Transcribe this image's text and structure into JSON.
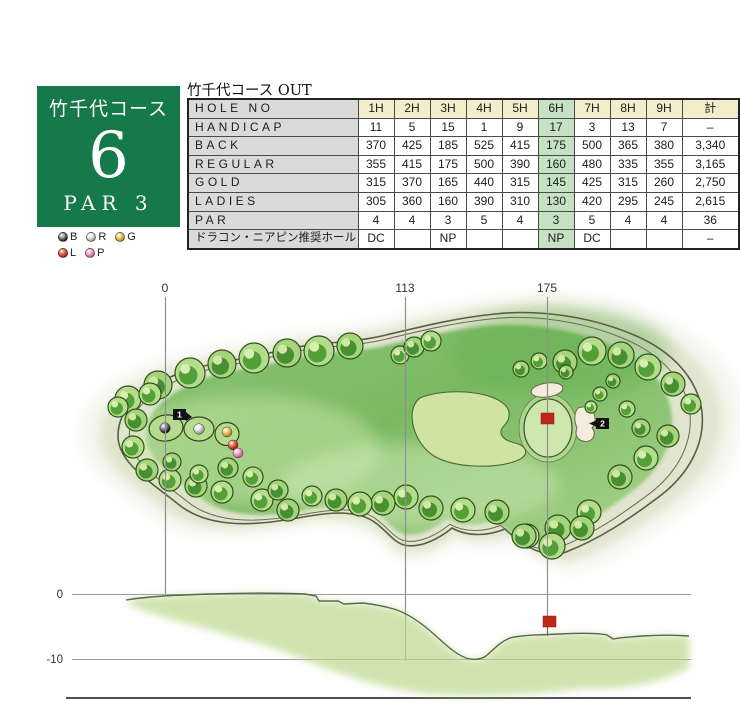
{
  "hole_card": {
    "course_name": "竹千代コース",
    "hole_number": "6",
    "par_label": "PAR 3",
    "bg_color": "#15794a"
  },
  "tee_legend": [
    {
      "label": "B",
      "light": "#9aa0a6",
      "dark": "#101418"
    },
    {
      "label": "R",
      "light": "#f0f0f0",
      "dark": "#8c9094"
    },
    {
      "label": "G",
      "light": "#f5d97e",
      "dark": "#b07c22"
    },
    {
      "label": "L",
      "light": "#e97b64",
      "dark": "#9c1a0c"
    },
    {
      "label": "P",
      "light": "#f7b8d6",
      "dark": "#c4538f"
    }
  ],
  "scorecard": {
    "title": "竹千代コース OUT",
    "current_hole_column": "6H",
    "columns": [
      "HOLE NO",
      "1H",
      "2H",
      "3H",
      "4H",
      "5H",
      "6H",
      "7H",
      "8H",
      "9H",
      "計"
    ],
    "rows": [
      {
        "label": "HANDICAP",
        "values": [
          "11",
          "5",
          "15",
          "1",
          "9",
          "17",
          "3",
          "13",
          "7",
          "–"
        ]
      },
      {
        "label": "BACK",
        "values": [
          "370",
          "425",
          "185",
          "525",
          "415",
          "175",
          "500",
          "365",
          "380",
          "3,340"
        ]
      },
      {
        "label": "REGULAR",
        "values": [
          "355",
          "415",
          "175",
          "500",
          "390",
          "160",
          "480",
          "335",
          "355",
          "3,165"
        ]
      },
      {
        "label": "GOLD",
        "values": [
          "315",
          "370",
          "165",
          "440",
          "315",
          "145",
          "425",
          "315",
          "260",
          "2,750"
        ]
      },
      {
        "label": "LADIES",
        "values": [
          "305",
          "360",
          "160",
          "390",
          "310",
          "130",
          "420",
          "295",
          "245",
          "2,615"
        ]
      },
      {
        "label": "PAR",
        "values": [
          "4",
          "4",
          "3",
          "5",
          "4",
          "3",
          "5",
          "4",
          "4",
          "36"
        ]
      },
      {
        "label": "ドラコン・ニアピン推奨ホール",
        "values": [
          "DC",
          "",
          "NP",
          "",
          "",
          "NP",
          "DC",
          "",
          "",
          "–"
        ]
      }
    ],
    "colors": {
      "header_bg": "#f4edca",
      "label_bg": "#dadada",
      "highlight_bg": "#c5e2c4"
    }
  },
  "course_map": {
    "distance_markers": [
      "0",
      "113",
      "175"
    ],
    "point_markers": [
      {
        "label": "1"
      },
      {
        "label": "2"
      }
    ],
    "pin_color": "#bf2718"
  },
  "elevation_profile": {
    "axis_labels": [
      "0",
      "-10"
    ]
  }
}
